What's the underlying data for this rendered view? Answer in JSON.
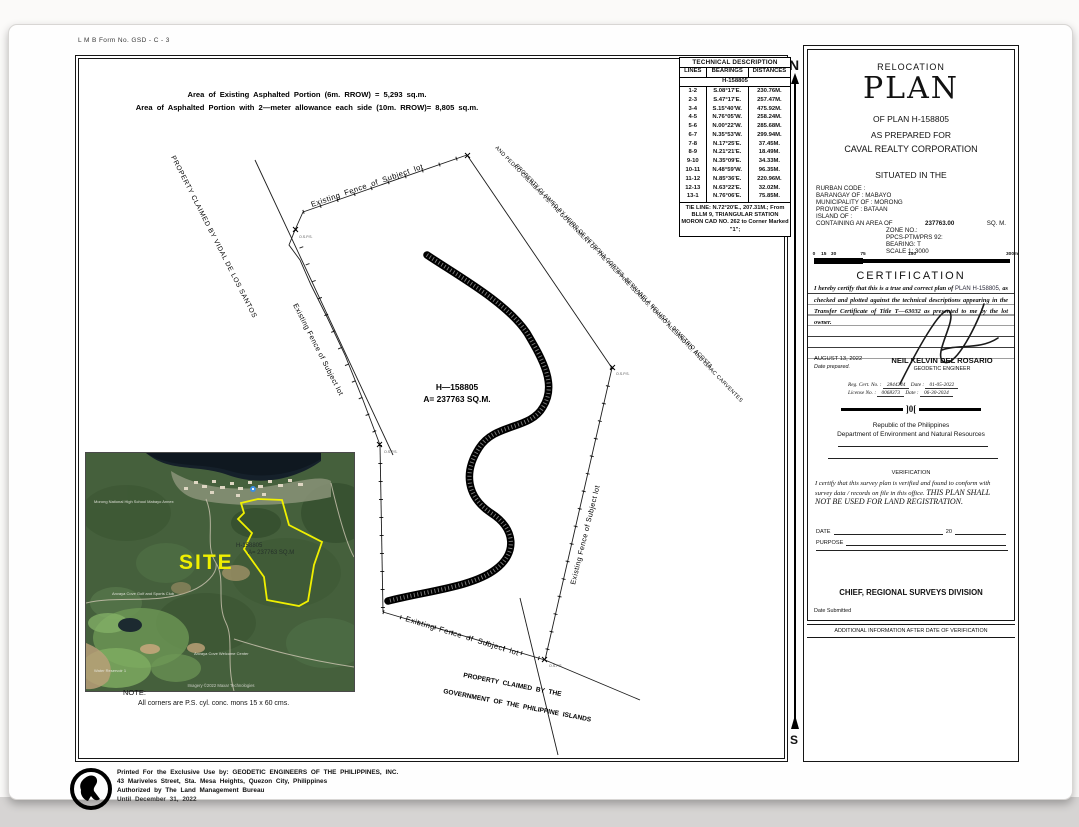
{
  "page": {
    "form_no": "L M B   Form No.  GSD - C - 3",
    "area_line1": "Area of Existing Asphalted Portion (6m. RROW) = 5,293 sq.m.",
    "area_line2": "Area of Asphalted Portion with 2—meter allowance each side (10m. RROW)= 8,805 sq.m."
  },
  "tech_table": {
    "title": "TECHNICAL DESCRIPTION",
    "headers": [
      "LINES",
      "BEARINGS",
      "DISTANCES"
    ],
    "subheader": "H-158805",
    "rows": [
      [
        "1-2",
        "S.08°17'E.",
        "230.76M."
      ],
      [
        "2-3",
        "S.47°17'E.",
        "257.47M."
      ],
      [
        "3-4",
        "S.15°40'W.",
        "475.92M."
      ],
      [
        "4-5",
        "N.76°05'W.",
        "258.24M."
      ],
      [
        "5-6",
        "N.00°22'W.",
        "285.68M."
      ],
      [
        "6-7",
        "N.35°53'W.",
        "299.94M."
      ],
      [
        "7-8",
        "N.17°25'E.",
        "37.45M."
      ],
      [
        "8-9",
        "N.21°21'E.",
        "18.49M."
      ],
      [
        "9-10",
        "N.35°09'E.",
        "34.33M."
      ],
      [
        "10-11",
        "N.48°59'W.",
        "96.35M."
      ],
      [
        "11-12",
        "N.85°36'E.",
        "220.96M."
      ],
      [
        "12-13",
        "N.63°22'E.",
        "32.02M."
      ],
      [
        "13-1",
        "N.76°06'E.",
        "75.85M."
      ]
    ],
    "tie_line": "TIE LINE: N.72°20'E., 207.31M.; From BLLM 9, TRIANGULAR STATION MORON CAD NO. 262 to Corner Marked \"1\";"
  },
  "map": {
    "north": "N",
    "south": "S",
    "fence_label": "Existing Fence of Subject lot",
    "vidal_label": "PROPERTY CLAIMED BY VIDAL DE LOS SANTOS",
    "heirs_label": "PROPERTY CLAIMED BY HEIRS OF PETRONA CORTES, BERNABELA BELUSAN, DEMETRIO ACOSTA,",
    "calimbas_label": "AND PEDRO CALIMBAS VS. THE GOVERNMENT OF THE PHILIPPINE ISLANDS, TORBIO ALEJANDRO, AND ISAAC CARVENTES",
    "govt_label1": "PROPERTY CLAIMED BY THE",
    "govt_label2": "GOVERNMENT OF THE PHILIPPINE ISLANDS",
    "lot_id": "H—158805",
    "lot_area": "A= 237763 SQ.M.",
    "corner_label": "O.S.P.S."
  },
  "inset": {
    "site_label": "SITE",
    "lot_id": "H-158805",
    "lot_area": "A= 237763 SQ.M",
    "poi": {
      "school": "Morong National High School Mabayo Annex",
      "golf": "Anvaya Cove Golf and Sports Club",
      "reservoir": "Water Reservoir 1",
      "welcome": "Anvaya Cove Welcome Center"
    },
    "credit": "Imagery ©2022 Maxar Technologies"
  },
  "note": {
    "title": "NOTE:",
    "body": "All corners are P.S. cyl. conc. mons 15 x 60 cms."
  },
  "title_block": {
    "heading_small": "RELOCATION",
    "heading_large": "PLAN",
    "of_plan": "OF PLAN H-158805",
    "prepared_for": "AS PREPARED FOR",
    "company": "CAVAL REALTY CORPORATION",
    "situated": "SITUATED IN THE",
    "fields": {
      "rurban": "RURBAN CODE :",
      "barangay": "BARANGAY OF :  MABAYO",
      "municipality": "MUNICIPALITY OF : MORONG",
      "province": "PROVINCE OF  :  BATAAN",
      "island": "ISLAND OF  :",
      "area_label": "CONTAINING AN AREA OF",
      "area_value": "237763.00",
      "area_unit": "SQ. M."
    },
    "zone": {
      "line1": "ZONE NO.:",
      "line2": "PPCS-PTM/PRS 92:",
      "line3": "BEARING: T",
      "line4": "SCALE 1: 3000"
    },
    "scale": {
      "ticks": [
        "0",
        "15",
        "30",
        "75",
        "150",
        "300"
      ],
      "unit": "m"
    },
    "certification_heading": "CERTIFICATION",
    "cert_text1": "I hereby certify that this is a true and correct plan of",
    "cert_plan": " PLAN H-158805, ",
    "cert_text2": "as checked and plotted against the technical descriptions appearing in the Transfer Certificate of Title T—63032 as presented to me by the lot owner.",
    "date_prepared_value": "AUGUST 13, 2022",
    "date_prepared_label": "Date prepared.",
    "engineer_name": "NEIL KELVIN DEL ROSARIO",
    "engineer_title": "GEODETIC ENGINEER",
    "reg_label": "Reg. Cert. No. :",
    "reg_value": "2844244",
    "reg_date_label": "Date :",
    "reg_date_value": "01-05-2022",
    "lic_label": "License No. :",
    "lic_value": "0068373",
    "lic_date_label": "Date :",
    "lic_date_value": "06-30-2024",
    "divider_glyph": "]0[",
    "republic_line1": "Republic of the Philippines",
    "republic_line2": "Department of Environment and Natural Resources",
    "verification_heading": "VERIFICATION",
    "verif_text1": "I certify that this survey plan is verified and found to conform with survey data / records on file in this office.",
    "verif_text2": "THIS PLAN SHALL NOT BE USED FOR LAND REGISTRATION.",
    "date_label": "DATE",
    "date_20": "20",
    "purpose_label": "PURPOSE",
    "chief_line": "CHIEF, REGIONAL SURVEYS DIVISION",
    "date_submitted": "Date Submitted",
    "additional_info": "ADDITIONAL INFORMATION AFTER DATE OF VERIFICATION"
  },
  "footer": {
    "line1": "Printed For the Exclusive Use by: GEODETIC ENGINEERS OF THE PHILIPPINES, INC.",
    "line2": "43 Mariveles Street, Sta. Mesa Heights, Quezon City, Philippines",
    "line3": "Authorized by The Land Management Bureau",
    "line4": "Until December 31, 2022"
  },
  "colors": {
    "site_yellow": "#f0f000",
    "forest_green": "#45603c",
    "water_dark": "#15202a"
  }
}
